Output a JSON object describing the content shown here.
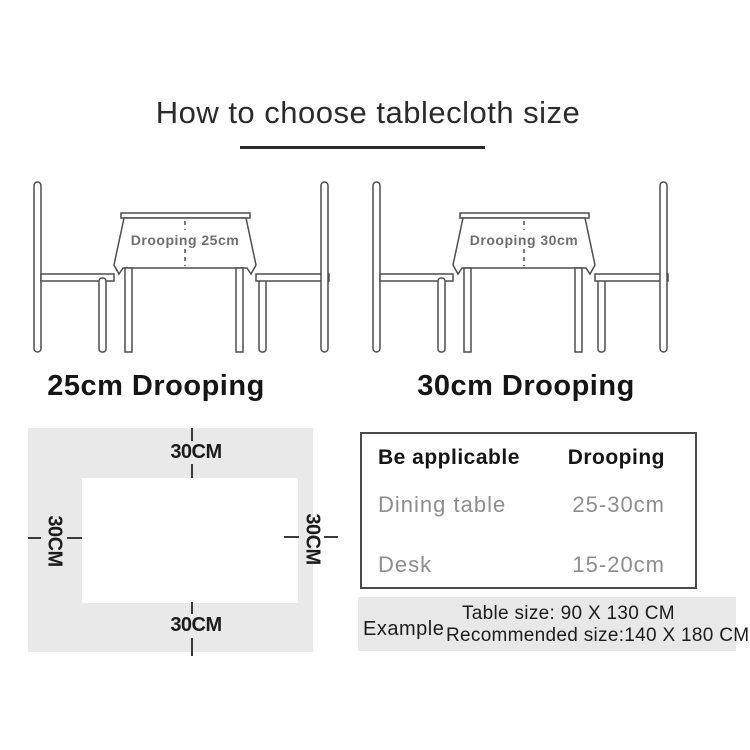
{
  "title": "How to choose tablecloth size",
  "illustrations": {
    "left": {
      "cloth_label": "Drooping 25cm",
      "caption": "25cm Drooping"
    },
    "right": {
      "cloth_label": "Drooping 30cm",
      "caption": "30cm Drooping"
    }
  },
  "size_diagram": {
    "top": "30CM",
    "right": "30CM",
    "bottom": "30CM",
    "left": "30CM"
  },
  "spec_table": {
    "headers": [
      "Be applicable",
      "Drooping"
    ],
    "rows": [
      {
        "item": "Dining table",
        "value": "25-30cm"
      },
      {
        "item": "Desk",
        "value": "15-20cm"
      }
    ]
  },
  "example": {
    "label": "Example",
    "table_size": "Table size:  90 X 130 CM",
    "recommended_size": "Recommended size:140 X 180 CM"
  },
  "colors": {
    "line": "#4d4d4d",
    "panel_gray": "#e9e9e9",
    "muted_text": "#8d8d8d",
    "text": "#1c1c1c"
  }
}
